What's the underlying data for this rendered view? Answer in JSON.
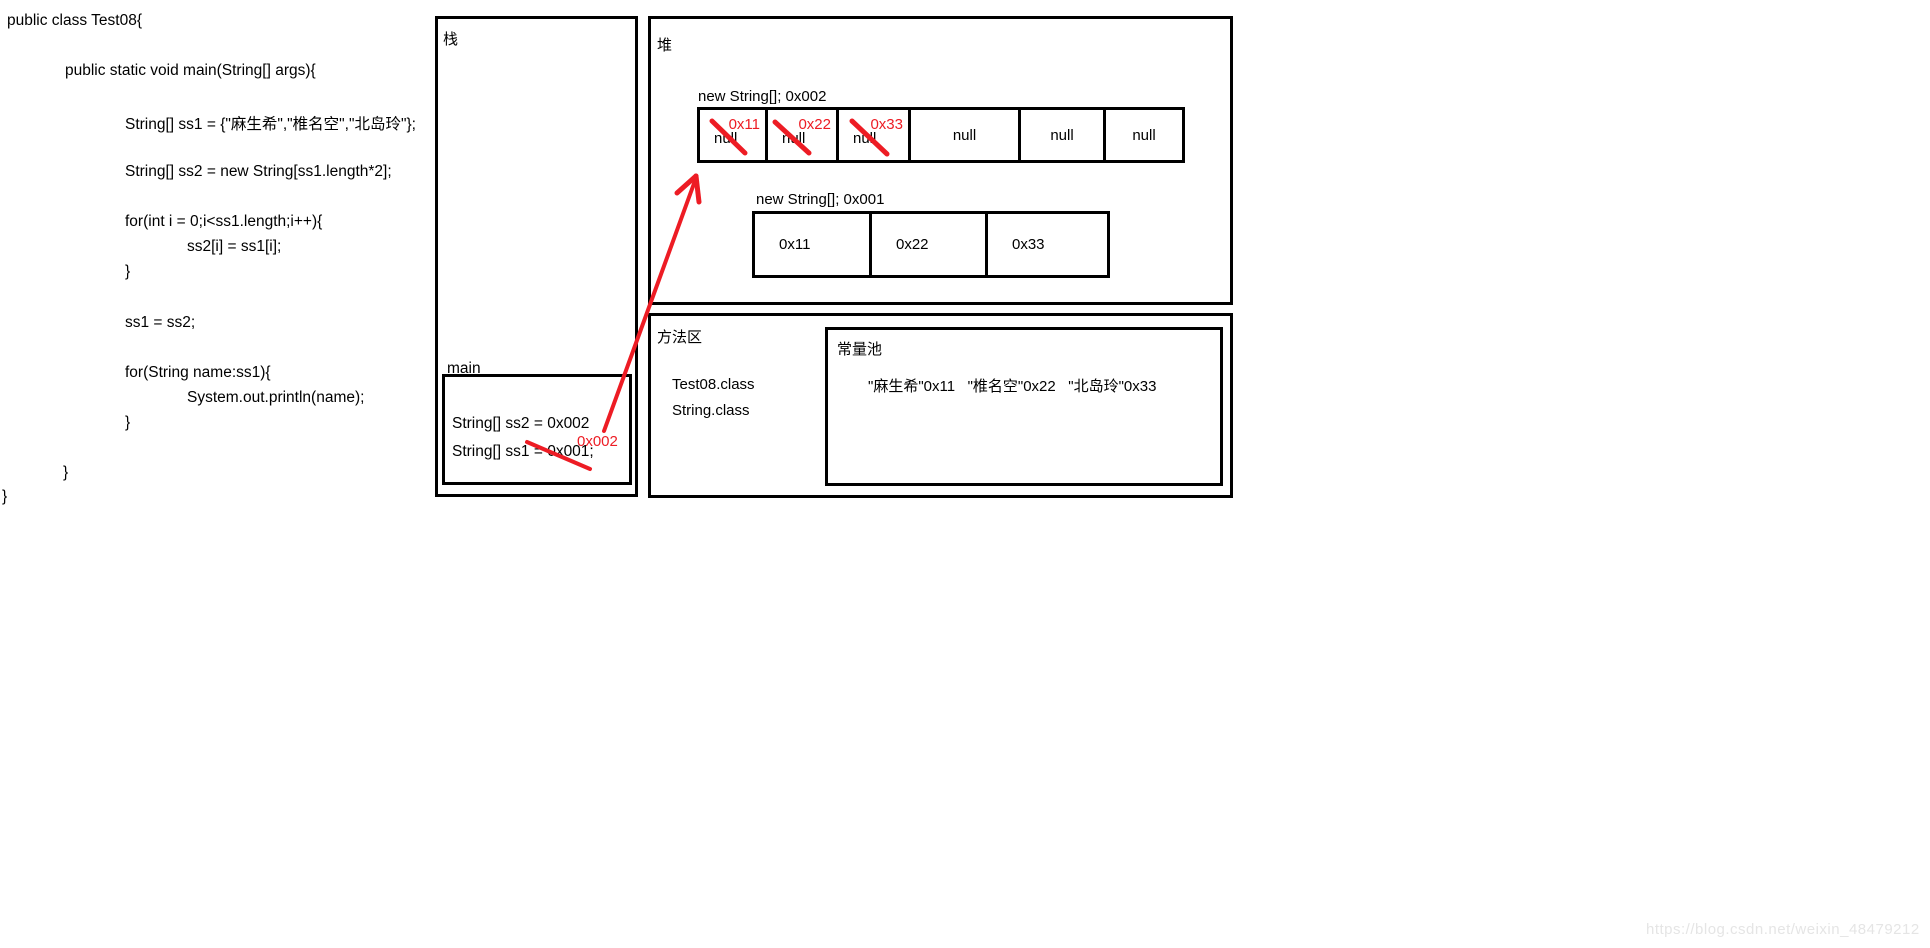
{
  "code": {
    "lines": [
      "public class Test08{",
      "public static void main(String[] args){",
      "String[] ss1 = {\"麻生希\",\"椎名空\",\"北岛玲\"};",
      "String[] ss2 = new String[ss1.length*2];",
      "for(int i = 0;i<ss1.length;i++){",
      "ss2[i] = ss1[i];",
      "}",
      "ss1 = ss2;",
      "for(String name:ss1){",
      "System.out.println(name);",
      "}",
      "}",
      "}"
    ]
  },
  "stack": {
    "label": "栈",
    "frame_label": "main",
    "var_ss2": "String[] ss2 = 0x002",
    "var_ss1": "String[] ss1 = 0x001;",
    "red_annotation": "0x002"
  },
  "heap": {
    "label": "堆",
    "array2": {
      "title": "new String[]; 0x002",
      "cells": [
        {
          "value": "null",
          "red_label": "0x11",
          "crossed": true
        },
        {
          "value": "null",
          "red_label": "0x22",
          "crossed": true
        },
        {
          "value": "null",
          "red_label": "0x33",
          "crossed": true
        },
        {
          "value": "null"
        },
        {
          "value": "null"
        },
        {
          "value": "null"
        }
      ]
    },
    "array1": {
      "title": "new String[]; 0x001",
      "cells": [
        {
          "value": "0x11"
        },
        {
          "value": "0x22"
        },
        {
          "value": "0x33"
        }
      ]
    }
  },
  "method_area": {
    "label": "方法区",
    "classes": [
      "Test08.class",
      "String.class"
    ],
    "constant_pool": {
      "label": "常量池",
      "entries": "\"麻生希\"0x11   \"椎名空\"0x22   \"北岛玲\"0x33"
    }
  },
  "watermark": "https://blog.csdn.net/weixin_48479212",
  "colors": {
    "annotation_red": "#ed1c24",
    "border_black": "#000000"
  }
}
